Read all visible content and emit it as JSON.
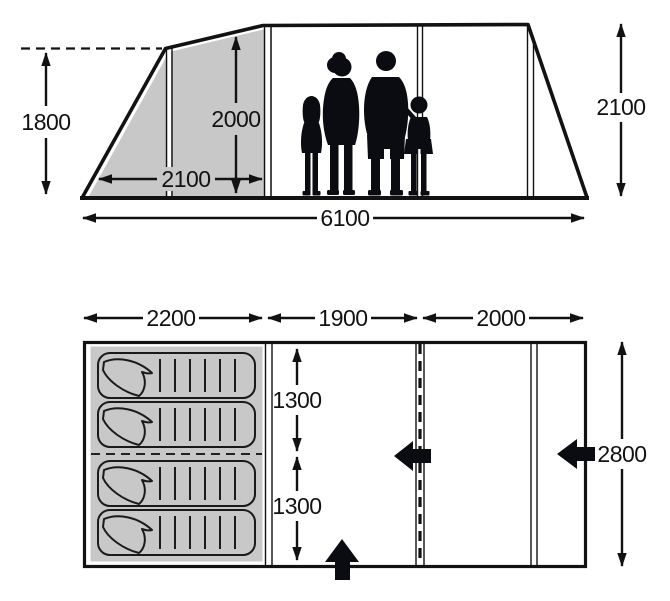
{
  "side_view": {
    "front_height_mm": "1800",
    "bedroom_height_mm": "2000",
    "front_section_depth_mm": "2100",
    "total_length_mm": "6100",
    "rear_height_mm": "2100"
  },
  "floor_plan": {
    "section_lengths_mm": [
      "2200",
      "1900",
      "2000"
    ],
    "berth_widths_mm": [
      "1300",
      "1300"
    ],
    "total_width_mm": "2800"
  },
  "icons": {
    "entrances": [
      "side-entrance-left-arrow",
      "rear-entrance-left-arrow",
      "front-entrance-up-arrow"
    ],
    "silhouettes": [
      "girl-silhouette",
      "woman-silhouette",
      "man-silhouette",
      "boy-silhouette"
    ],
    "sleeping_bags_count": 4
  },
  "colors": {
    "shaded_panel": "#c8c8c8",
    "line": "#121212",
    "background": "#ffffff"
  }
}
